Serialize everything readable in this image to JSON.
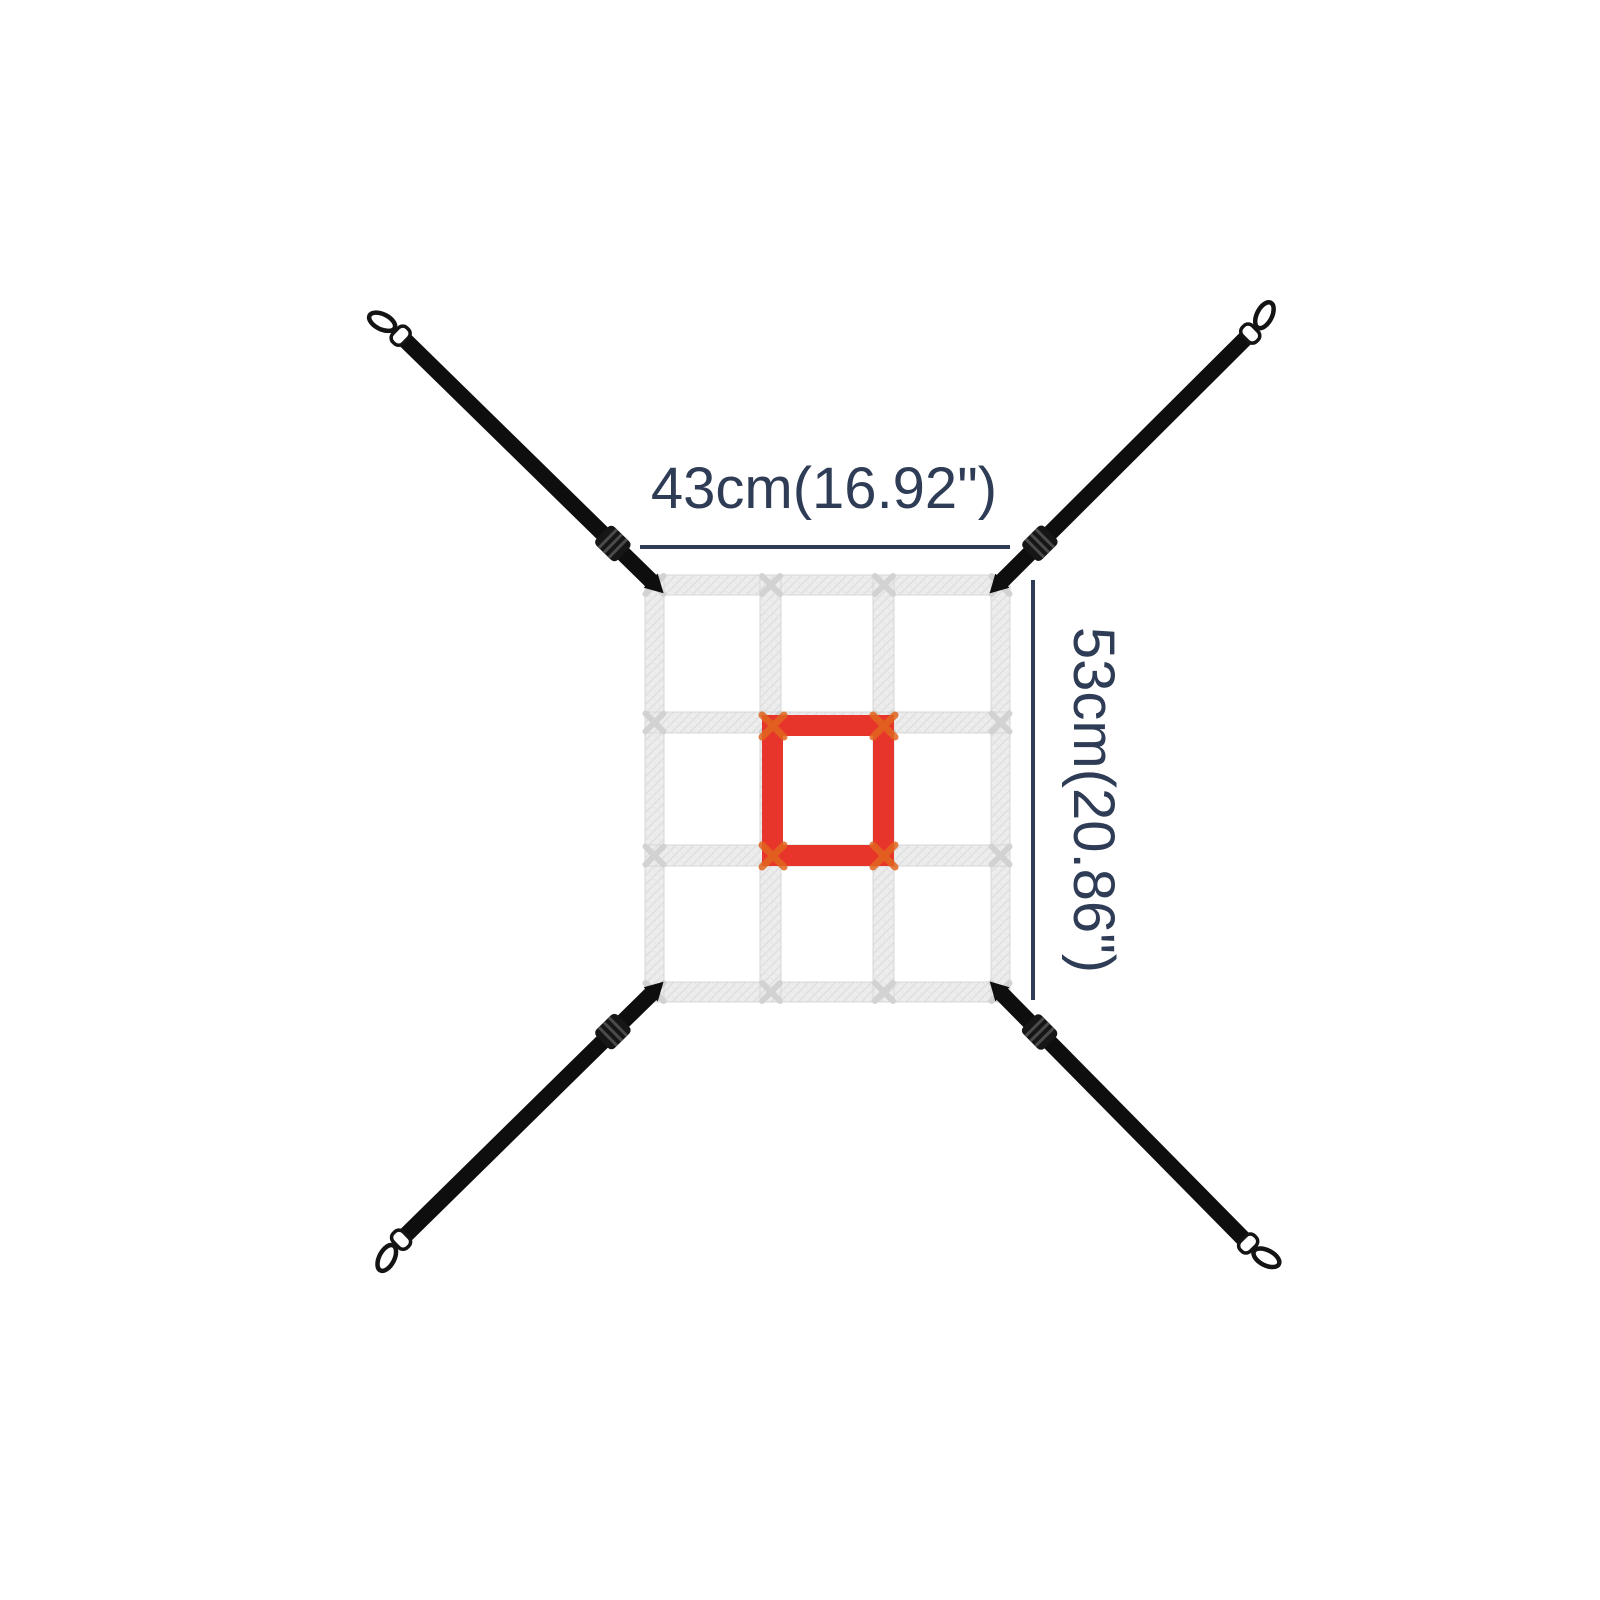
{
  "diagram": {
    "width_label": "43cm(16.92\")",
    "height_label": "53cm(20.86\")"
  },
  "net": {
    "rows": 3,
    "columns": 3,
    "target": "center cell outlined in red"
  },
  "icons": {
    "carabiner_clip": "snap-hook outline at the end of each strap",
    "strap_adjuster": "ladder-lock buckle on each strap near the net corner"
  },
  "colors": {
    "background": "#ffffff",
    "dimension": "#2e3c55",
    "strap": "#0e0e0e",
    "buckle": "#161616",
    "buckle_ridge": "#4a4a4a",
    "net_band": "#ededed",
    "net_texture": "#dfdfdf",
    "net_texture2": "#e7e7e7",
    "net_band_edge": "#d7d7d7",
    "stitch": "#d2d2d2",
    "corner_stitch": "#e2661f",
    "target_red": "#e8352b",
    "clip_fill": "#ffffff",
    "clip_stroke": "#141414"
  }
}
